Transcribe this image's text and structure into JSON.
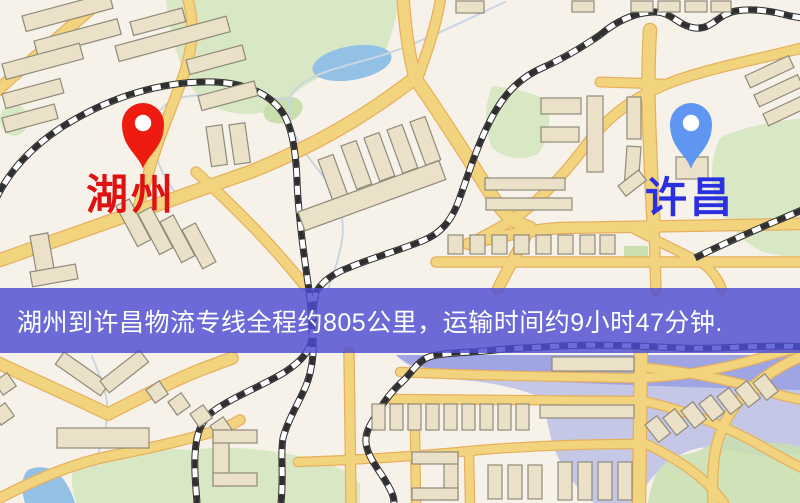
{
  "banner": {
    "text": "湖州到许昌物流专线全程约805公里，运输时间约9小时47分钟."
  },
  "markers": {
    "origin": {
      "label": "湖州"
    },
    "destination": {
      "label": "许昌"
    }
  },
  "colors": {
    "map_bg": "#f7f2e9",
    "road_fill": "#f3d47e",
    "road_casing": "#e6b05f",
    "building_fill": "#eae1c8",
    "building_stroke": "#8f8a7a",
    "green_area": "#d9e8c4",
    "green_dark": "#c9dfae",
    "water": "#93c1e6",
    "water_overlay": "rgba(120,135,225,0.40)",
    "water_band": "rgba(105,118,222,0.42)",
    "railway_dark": "#2f2f2f",
    "stream": "#c9d6e2",
    "origin_pin": "#ee1c10",
    "origin_label": "#df1111",
    "destination_pin": "#5e96f2",
    "destination_label": "#2a2fdf",
    "banner_bg": "rgba(76,76,210,0.82)",
    "banner_text": "#ffffff"
  }
}
